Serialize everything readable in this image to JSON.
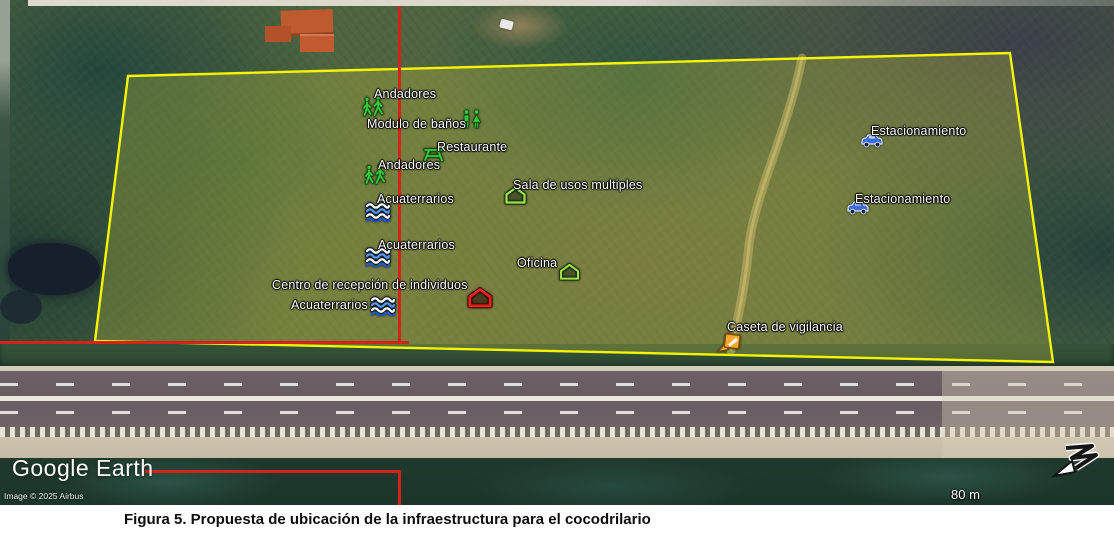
{
  "caption": {
    "text": "Figura 5. Propuesta de ubicación de la infraestructura para el cocodrilario"
  },
  "map": {
    "logo_text": "Google Earth",
    "attribution": "Image © 2025 Airbus",
    "scale_label": "80 m",
    "compass_icon": "north-arrow-icon",
    "colors": {
      "boundary_yellow": "#f6f303",
      "annotation_red": "#d42318",
      "label_white": "#ffffff"
    },
    "placemarks": [
      {
        "label": "Andadores",
        "icon": "hikers-icon",
        "label_x": 374,
        "label_y": 87,
        "icon_x": 362,
        "icon_y": 96,
        "icon_w": 24,
        "icon_h": 21
      },
      {
        "label": "Modulo de baños",
        "icon": "restroom-icon",
        "label_x": 367,
        "label_y": 117,
        "icon_x": 461,
        "icon_y": 109,
        "icon_w": 21,
        "icon_h": 20
      },
      {
        "label": "Restaurante",
        "icon": "picnic-table-icon",
        "label_x": 437,
        "label_y": 140,
        "icon_x": 422,
        "icon_y": 147,
        "icon_w": 23,
        "icon_h": 15
      },
      {
        "label": "Andadores",
        "icon": "hikers-icon",
        "label_x": 378,
        "label_y": 158,
        "icon_x": 364,
        "icon_y": 164,
        "icon_w": 24,
        "icon_h": 21
      },
      {
        "label": "Acuaterrarios",
        "icon": "waves-icon",
        "label_x": 377,
        "label_y": 192,
        "icon_x": 365,
        "icon_y": 202,
        "icon_w": 26,
        "icon_h": 20
      },
      {
        "label": "Acuaterrarios",
        "icon": "waves-icon",
        "label_x": 378,
        "label_y": 238,
        "icon_x": 365,
        "icon_y": 247,
        "icon_w": 26,
        "icon_h": 20
      },
      {
        "label": "Centro de recepción de individuos",
        "icon": "red-house-icon",
        "label_x": 272,
        "label_y": 278,
        "icon_x": 467,
        "icon_y": 287,
        "icon_w": 26,
        "icon_h": 22
      },
      {
        "label": "Acuaterrarios",
        "icon": "waves-icon",
        "label_x": 291,
        "label_y": 298,
        "icon_x": 370,
        "icon_y": 296,
        "icon_w": 26,
        "icon_h": 20
      },
      {
        "label": "Sala de usos multiples",
        "icon": "green-house-icon",
        "label_x": 513,
        "label_y": 178,
        "icon_x": 504,
        "icon_y": 186,
        "icon_w": 23,
        "icon_h": 19
      },
      {
        "label": "Oficina",
        "icon": "green-house-icon",
        "label_x": 517,
        "label_y": 256,
        "icon_x": 558,
        "icon_y": 263,
        "icon_w": 23,
        "icon_h": 18
      },
      {
        "label": "Estacionamiento",
        "icon": "car-icon",
        "label_x": 871,
        "label_y": 124,
        "icon_x": 860,
        "icon_y": 132,
        "icon_w": 24,
        "icon_h": 16
      },
      {
        "label": "Estacionamiento",
        "icon": "car-icon",
        "label_x": 855,
        "label_y": 192,
        "icon_x": 846,
        "icon_y": 199,
        "icon_w": 24,
        "icon_h": 16
      },
      {
        "label": "Caseta de vigilancia",
        "icon": "ranger-station-icon",
        "label_x": 727,
        "label_y": 320,
        "icon_x": 716,
        "icon_y": 332,
        "icon_w": 27,
        "icon_h": 21
      }
    ]
  }
}
